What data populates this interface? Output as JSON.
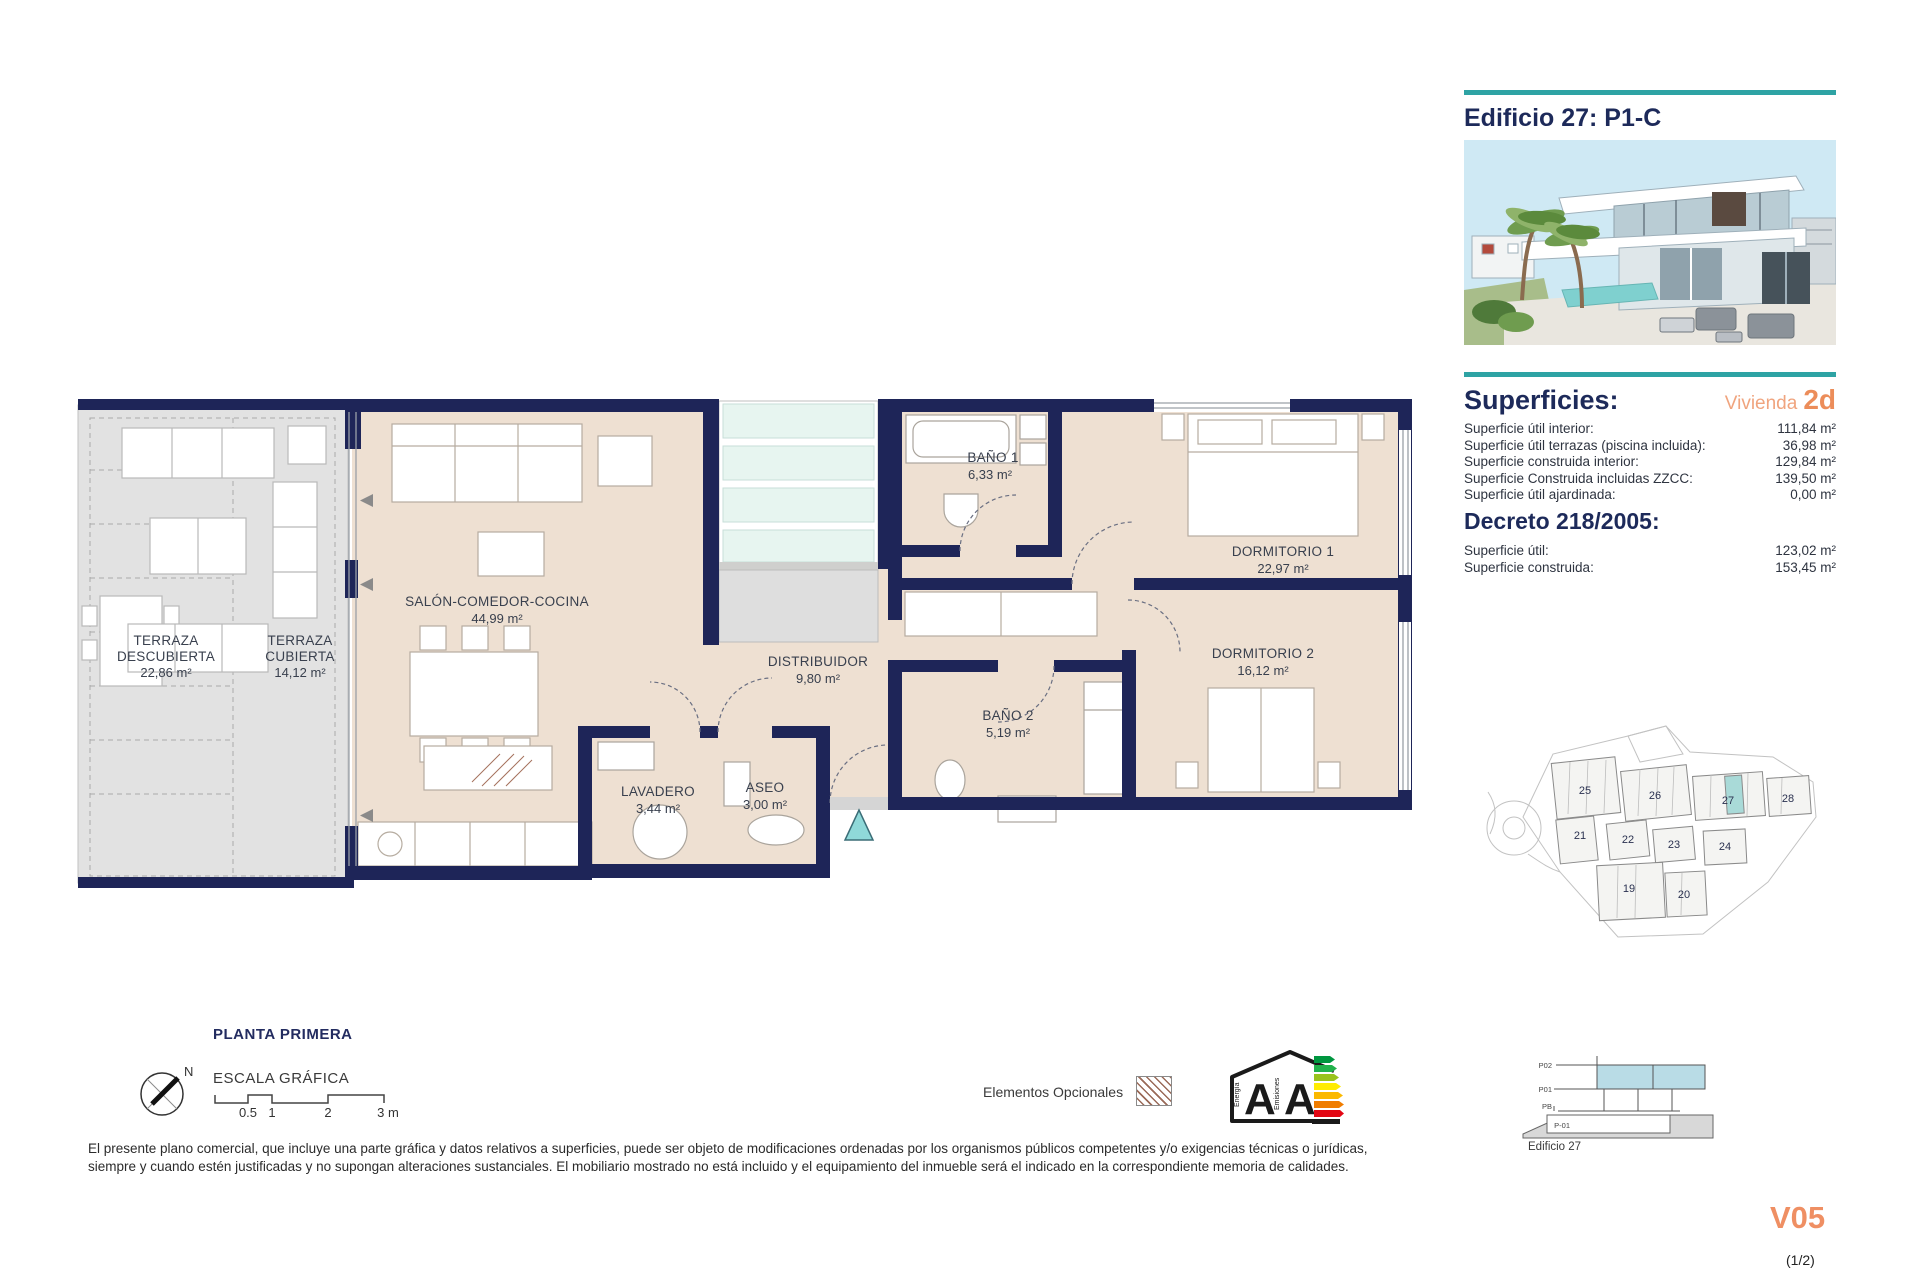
{
  "header": {
    "title": "Edificio 27: P1-C"
  },
  "accent_colors": {
    "teal": "#2ea3a4",
    "orange": "#ee8f60",
    "navy": "#1e2558",
    "floor_beige": "#eee0d2",
    "terrace_gray": "#e2e2e2",
    "glass_teal": "#e7f5f0",
    "entrance_teal": "#8fd9d9"
  },
  "plan": {
    "title": "PLANTA PRIMERA",
    "north": "N",
    "scale": {
      "label": "ESCALA GRÁFICA",
      "ticks": [
        "0.5",
        "1",
        "2",
        "3 m"
      ]
    },
    "rooms": {
      "terraza_descubierta": {
        "line1": "TERRAZA",
        "line2": "DESCUBIERTA",
        "area": "22,86 m²"
      },
      "terraza_cubierta": {
        "line1": "TERRAZA",
        "line2": "CUBIERTA",
        "area": "14,12 m²"
      },
      "salon": {
        "name": "SALÓN-COMEDOR-COCINA",
        "area": "44,99 m²"
      },
      "bano1": {
        "name": "BAÑO 1",
        "area": "6,33 m²"
      },
      "dormitorio1": {
        "name": "DORMITORIO 1",
        "area": "22,97 m²"
      },
      "distribuidor": {
        "name": "DISTRIBUIDOR",
        "area": "9,80 m²"
      },
      "bano2": {
        "name": "BAÑO 2",
        "area": "5,19 m²"
      },
      "dormitorio2": {
        "name": "DORMITORIO 2",
        "area": "16,12 m²"
      },
      "lavadero": {
        "name": "LAVADERO",
        "area": "3,44 m²"
      },
      "aseo": {
        "name": "ASEO",
        "area": "3,00 m²"
      }
    }
  },
  "superficies": {
    "heading": "Superficies:",
    "vivienda_label": "Vivienda",
    "vivienda_unit": "2d",
    "rows": [
      {
        "label": "Superficie útil interior:",
        "value": "111,84 m²"
      },
      {
        "label": "Superficie útil terrazas (piscina incluida):",
        "value": "36,98 m²"
      },
      {
        "label": "Superficie construida interior:",
        "value": "129,84 m²"
      },
      {
        "label": "Superficie Construida incluidas ZZCC:",
        "value": "139,50 m²"
      },
      {
        "label": "Superficie útil ajardinada:",
        "value": "0,00 m²"
      }
    ],
    "decreto_heading": "Decreto 218/2005:",
    "decreto_rows": [
      {
        "label": "Superficie útil:",
        "value": "123,02 m²"
      },
      {
        "label": "Superficie construida:",
        "value": "153,45 m²"
      }
    ]
  },
  "site_plan": {
    "buildings": {
      "b19": "19",
      "b20": "20",
      "b21": "21",
      "b22": "22",
      "b23": "23",
      "b24": "24",
      "b25": "25",
      "b26": "26",
      "b27": "27",
      "b28": "28"
    },
    "highlighted": "27"
  },
  "section": {
    "levels": {
      "p02": "P02",
      "p01": "P01",
      "pb": "PB",
      "pm1": "P-01"
    },
    "caption": "Edificio 27"
  },
  "legend": {
    "optional_label": "Elementos Opcionales"
  },
  "energy": {
    "left_axis": "Energía",
    "right_axis": "Emisiones",
    "letter1": "A",
    "letter2": "A",
    "bar_colors": [
      "#00963f",
      "#21b24b",
      "#99c31c",
      "#ffec00",
      "#fbb900",
      "#f07d00",
      "#e30613"
    ]
  },
  "disclaimer": {
    "line1": "El presente plano comercial, que incluye una parte gráfica y datos relativos a superficies, puede ser objeto de modificaciones ordenadas por los organismos públicos competentes y/o exigencias técnicas o jurídicas,",
    "line2": "siempre y cuando estén justificadas y no supongan alteraciones sustanciales. El mobiliario mostrado no está incluido y el equipamiento del inmueble será el indicado en la correspondiente memoria de calidades."
  },
  "footer": {
    "version": "V05",
    "page": "(1/2)"
  }
}
